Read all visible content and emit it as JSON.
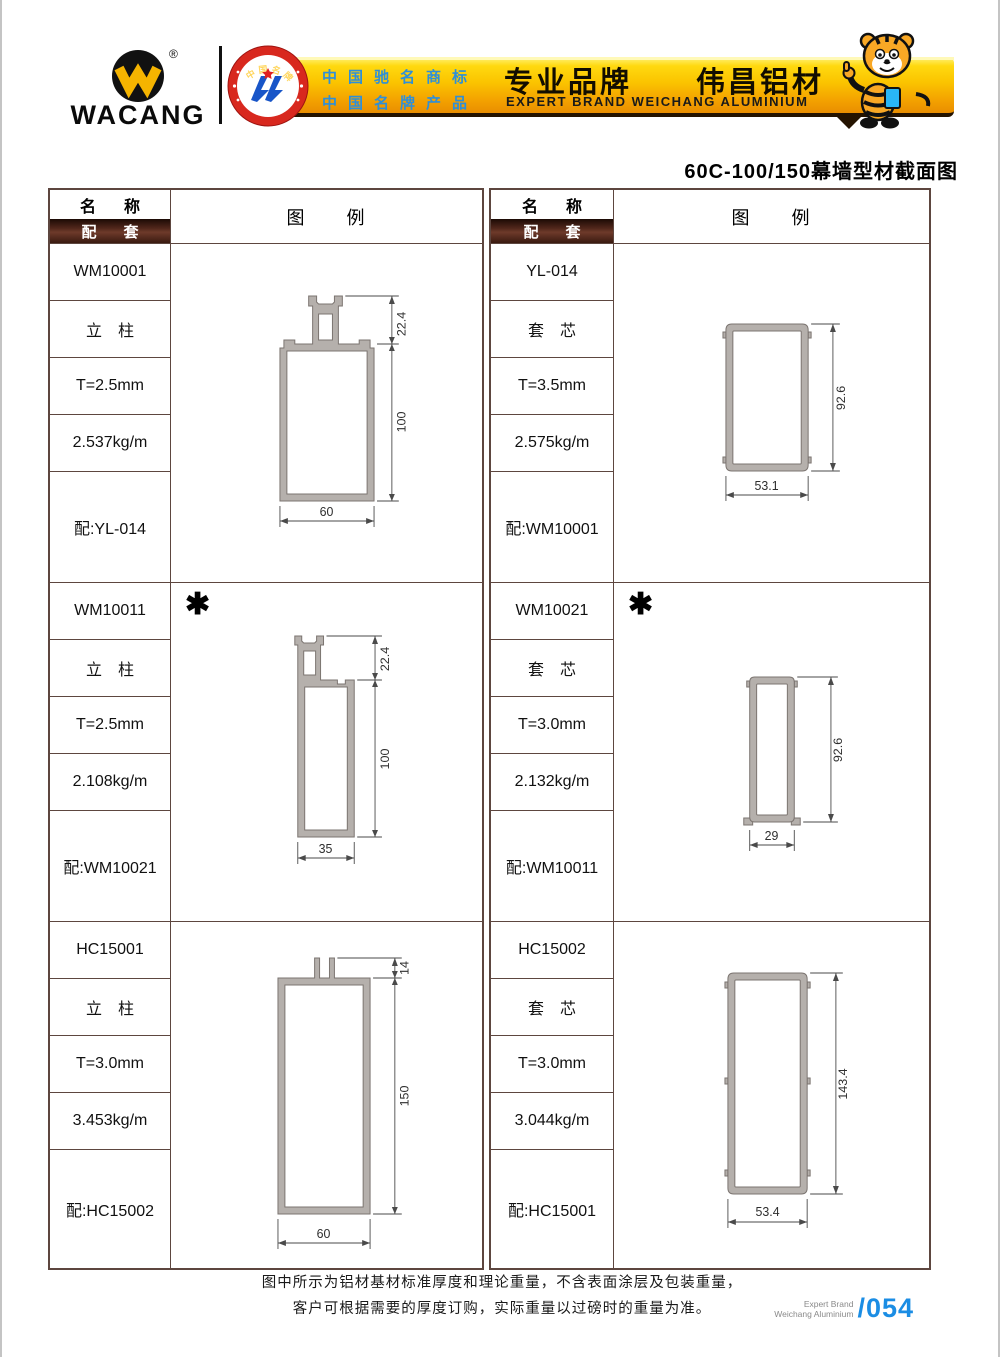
{
  "header": {
    "logo_text": "WACANG",
    "registered_mark": "®",
    "badge": {
      "top_text": "中国名牌",
      "bottom_text": "CHINA TOP BRAND"
    },
    "accreditation_line1": "中国驰名商标",
    "accreditation_line2": "中国名牌产品",
    "banner_title_cn": "专业品牌　　伟昌铝材",
    "banner_title_en": "EXPERT BRAND WEICHANG ALUMINIUM"
  },
  "page_title": "60C-100/150幕墙型材截面图",
  "table_headers": {
    "name": "名　称",
    "pairing": "配　套",
    "diagram": "图　　例"
  },
  "columns": [
    {
      "products": [
        {
          "code": "WM10001",
          "type": "立　柱",
          "thickness": "T=2.5mm",
          "weight": "2.537kg/m",
          "pairing": "配:YL-014",
          "asterisk": "",
          "dims": {
            "top": "22.4",
            "height": "100",
            "width": "60"
          }
        },
        {
          "code": "WM10011",
          "type": "立　柱",
          "thickness": "T=2.5mm",
          "weight": "2.108kg/m",
          "pairing": "配:WM10021",
          "asterisk": "✱",
          "dims": {
            "top": "22.4",
            "height": "100",
            "width": "35"
          }
        },
        {
          "code": "HC15001",
          "type": "立　柱",
          "thickness": "T=3.0mm",
          "weight": "3.453kg/m",
          "pairing": "配:HC15002",
          "asterisk": "",
          "dims": {
            "top": "14",
            "height": "150",
            "width": "60"
          }
        }
      ]
    },
    {
      "products": [
        {
          "code": "YL-014",
          "type": "套　芯",
          "thickness": "T=3.5mm",
          "weight": "2.575kg/m",
          "pairing": "配:WM10001",
          "asterisk": "",
          "dims": {
            "height": "92.6",
            "width": "53.1"
          }
        },
        {
          "code": "WM10021",
          "type": "套　芯",
          "thickness": "T=3.0mm",
          "weight": "2.132kg/m",
          "pairing": "配:WM10011",
          "asterisk": "✱",
          "dims": {
            "height": "92.6",
            "width": "29"
          }
        },
        {
          "code": "HC15002",
          "type": "套　芯",
          "thickness": "T=3.0mm",
          "weight": "3.044kg/m",
          "pairing": "配:HC15001",
          "asterisk": "",
          "dims": {
            "height": "143.4",
            "width": "53.4"
          }
        }
      ]
    }
  ],
  "footer": {
    "note_line1": "图中所示为铝材基材标准厚度和理论重量，不含表面涂层及包装重量，",
    "note_line2": "客户可根据需要的厚度订购，实际重量以过磅时的重量为准。",
    "brand_line1": "Expert Brand",
    "brand_line2": "Weichang Aluminium",
    "page_number": "/054"
  },
  "colors": {
    "banner_gold": "#fbc400",
    "accreditation_blue": "#2e8fd8",
    "pairing_bar_brown": "#53281c",
    "table_border": "#5d463f",
    "profile_grey": "#b5b0ac",
    "page_number_blue": "#1b8de4",
    "badge_red": "#d8281e",
    "logo_yellow": "#f5b400"
  }
}
